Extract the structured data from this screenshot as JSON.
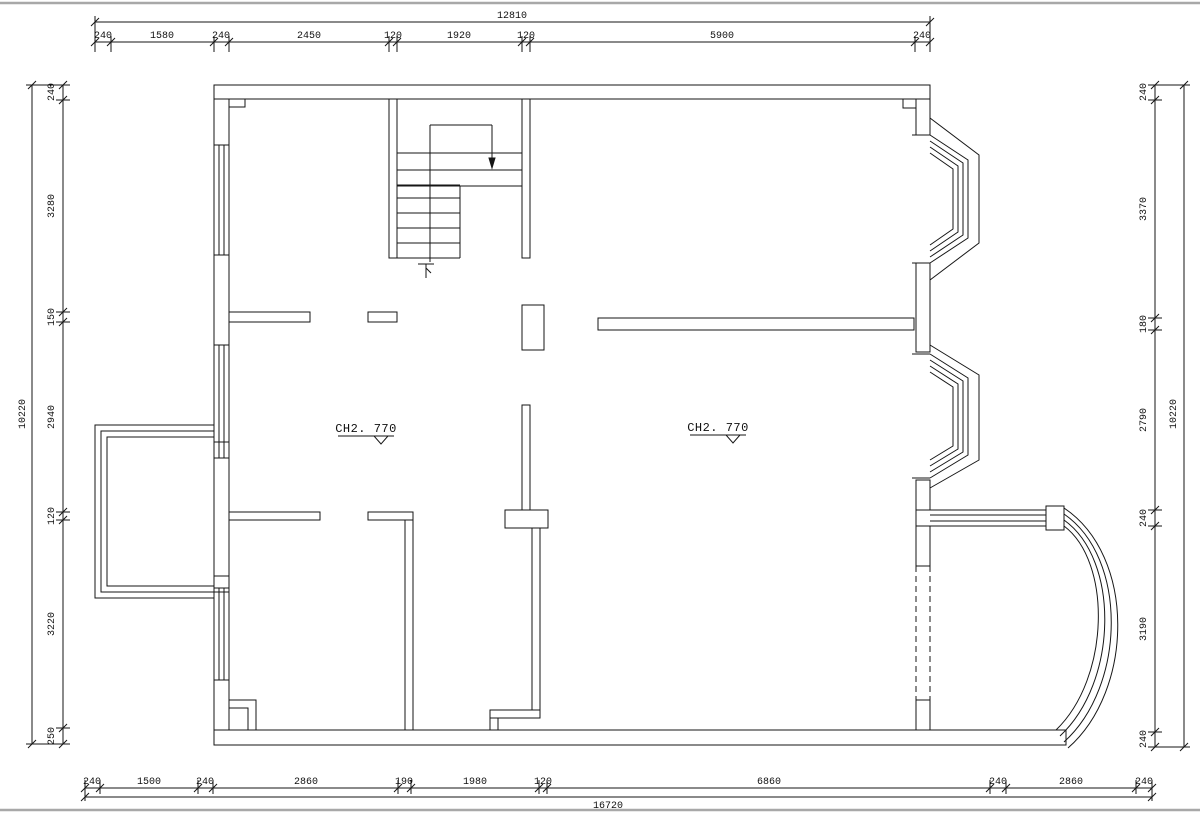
{
  "title": "Residential floor plan (CAD drawing)",
  "dims": {
    "top": {
      "overall": "12810",
      "segments": [
        "240",
        "1580",
        "240",
        "2450",
        "120",
        "1920",
        "120",
        "5900",
        "240"
      ]
    },
    "bottom": {
      "overall": "16720",
      "segments": [
        "240",
        "1500",
        "240",
        "2860",
        "190",
        "1980",
        "120",
        "6860",
        "240",
        "2860",
        "240"
      ]
    },
    "left": {
      "overall": "10220",
      "segments": [
        "240",
        "3280",
        "150",
        "2940",
        "120",
        "3220",
        "250"
      ]
    },
    "right": {
      "overall": "10220",
      "segments": [
        "240",
        "3370",
        "180",
        "2790",
        "240",
        "3190",
        "240"
      ]
    }
  },
  "labels": {
    "ceiling_left": "CH2. 770",
    "ceiling_right": "CH2. 770",
    "stair_direction": "下"
  },
  "colors": {
    "line": "#161616",
    "frame": "#a8a8a8",
    "background": "#ffffff"
  }
}
